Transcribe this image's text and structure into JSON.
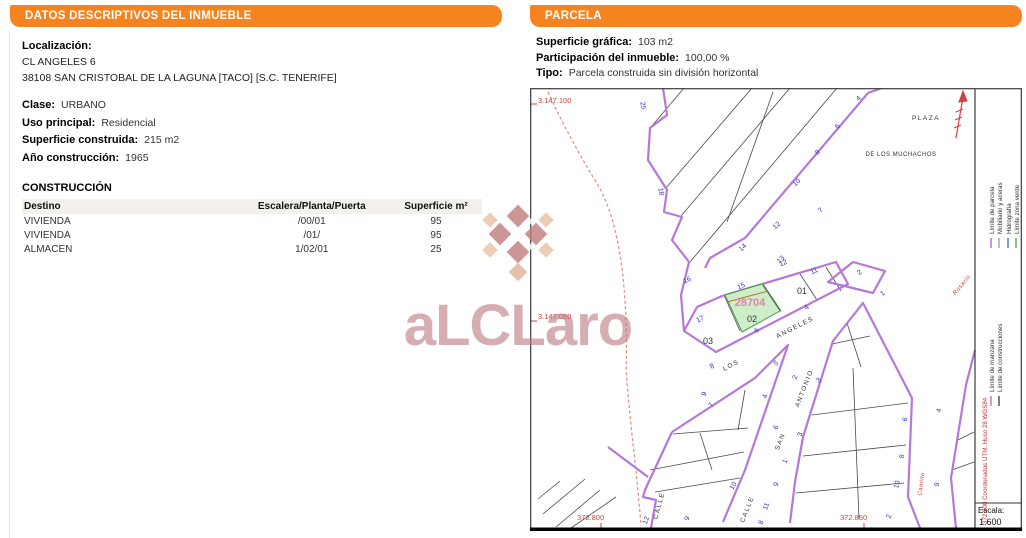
{
  "colors": {
    "accent_orange": "#F5831F",
    "parcel_line_purple": "#b678d8",
    "highlight_green_fill": "#cdeec8",
    "ref_pink": "#e37fb1",
    "coord_red": "#cf4436",
    "house_number_blue": "#2a35c0"
  },
  "left_panel": {
    "header": "DATOS DESCRIPTIVOS DEL INMUEBLE",
    "localizacion_label": "Localización:",
    "address_line1": "CL ANGELES 6",
    "address_line2": "38108 SAN CRISTOBAL DE LA LAGUNA [TACO] [S.C. TENERIFE]",
    "fields": [
      {
        "label": "Clase:",
        "value": "URBANO"
      },
      {
        "label": "Uso principal:",
        "value": "Residencial"
      },
      {
        "label": "Superficie construida:",
        "value": "215 m2"
      },
      {
        "label": "Año construcción:",
        "value": "1965"
      }
    ],
    "construccion": {
      "title": "CONSTRUCCIÓN",
      "columns": [
        "Destino",
        "Escalera/Planta/Puerta",
        "Superficie m²"
      ],
      "rows": [
        [
          "VIVIENDA",
          "/00/01",
          "95"
        ],
        [
          "VIVIENDA",
          "/01/",
          "95"
        ],
        [
          "ALMACEN",
          "1/02/01",
          "25"
        ]
      ]
    }
  },
  "right_panel": {
    "header": "PARCELA",
    "fields": [
      {
        "label": "Superficie gráfica:",
        "value": "103 m2"
      },
      {
        "label": "Participación del inmueble:",
        "value": "100,00 %"
      },
      {
        "label": "Tipo:",
        "value": "Parcela construida sin división horizontal"
      }
    ]
  },
  "map": {
    "coord_labels": {
      "top_left": "3.147.100",
      "mid_left": "3.147.050",
      "bottom_left": "372.800",
      "bottom_right": "372.850"
    },
    "plaza": {
      "line1": "PLAZA",
      "line2": "DE LOS MUCHACHOS"
    },
    "parcel_ref": "28704",
    "parcel_numbers": {
      "p01": "01",
      "p02": "02",
      "p03": "03"
    },
    "street_labels": {
      "angeles": "ANGELES",
      "los": "LOS",
      "calle_sa": "CALLE",
      "san": "SAN",
      "antonio": "ANTONIO",
      "calle_bl": "CALLE",
      "camino": "Camino",
      "rosario": "Rosario"
    },
    "house_numbers": [
      {
        "t": "25",
        "x": 641,
        "y": 106,
        "r": 78
      },
      {
        "t": "18",
        "x": 659,
        "y": 192,
        "r": 78
      },
      {
        "t": "14",
        "x": 744,
        "y": 249,
        "r": -42
      },
      {
        "t": "12",
        "x": 778,
        "y": 227,
        "r": -42
      },
      {
        "t": "10",
        "x": 798,
        "y": 184,
        "r": -42
      },
      {
        "t": "8",
        "x": 819,
        "y": 154,
        "r": -42
      },
      {
        "t": "6",
        "x": 839,
        "y": 128,
        "r": -42
      },
      {
        "t": "4",
        "x": 860,
        "y": 100,
        "r": -42
      },
      {
        "t": "13",
        "x": 782,
        "y": 261,
        "r": -42
      },
      {
        "t": "7",
        "x": 822,
        "y": 212,
        "r": -42
      },
      {
        "t": "16",
        "x": 688,
        "y": 282,
        "r": -25
      },
      {
        "t": "17",
        "x": 701,
        "y": 321,
        "r": -25
      },
      {
        "t": "15",
        "x": 742,
        "y": 288,
        "r": -25
      },
      {
        "t": "12",
        "x": 784,
        "y": 265,
        "r": -25
      },
      {
        "t": "11",
        "x": 815,
        "y": 273,
        "r": -25
      },
      {
        "t": "4",
        "x": 808,
        "y": 309,
        "r": -40
      },
      {
        "t": "6",
        "x": 758,
        "y": 332,
        "r": -40
      },
      {
        "t": "8",
        "x": 713,
        "y": 368,
        "r": -30
      },
      {
        "t": "2",
        "x": 861,
        "y": 274,
        "r": -40
      },
      {
        "t": "5",
        "x": 777,
        "y": 365,
        "r": -30
      },
      {
        "t": "9",
        "x": 706,
        "y": 395,
        "r": -60
      },
      {
        "t": "7",
        "x": 713,
        "y": 406,
        "r": -60
      },
      {
        "t": "4",
        "x": 767,
        "y": 397,
        "r": -70
      },
      {
        "t": "6",
        "x": 778,
        "y": 428,
        "r": -70
      },
      {
        "t": "1",
        "x": 787,
        "y": 462,
        "r": -70
      },
      {
        "t": "9",
        "x": 778,
        "y": 485,
        "r": -70
      },
      {
        "t": "11",
        "x": 768,
        "y": 507,
        "r": -70
      },
      {
        "t": "8",
        "x": 763,
        "y": 523,
        "r": -70
      },
      {
        "t": "2",
        "x": 797,
        "y": 378,
        "r": -70
      },
      {
        "t": "3",
        "x": 820,
        "y": 382,
        "r": -40
      },
      {
        "t": "3",
        "x": 802,
        "y": 435,
        "r": -70
      },
      {
        "t": "1",
        "x": 884,
        "y": 295,
        "r": -40
      },
      {
        "t": "12",
        "x": 648,
        "y": 521,
        "r": -70
      },
      {
        "t": "9",
        "x": 689,
        "y": 519,
        "r": -70
      },
      {
        "t": "10",
        "x": 735,
        "y": 487,
        "r": -60
      },
      {
        "t": "6",
        "x": 907,
        "y": 420,
        "r": -75
      },
      {
        "t": "8",
        "x": 904,
        "y": 457,
        "r": -75
      },
      {
        "t": "10",
        "x": 899,
        "y": 485,
        "r": -75
      },
      {
        "t": "2",
        "x": 891,
        "y": 517,
        "r": -75
      },
      {
        "t": "9",
        "x": 939,
        "y": 485,
        "r": -75
      },
      {
        "t": "4",
        "x": 941,
        "y": 411,
        "r": -75
      }
    ],
    "legend": {
      "entries": [
        {
          "label": "Límite de parcela",
          "color": "#b678d8"
        },
        {
          "label": "Mobiliario y aceras",
          "color": "#a8a8a8"
        },
        {
          "label": "Hidrografía",
          "color": "#5577cc"
        },
        {
          "label": "Límite zona verde",
          "color": "#66aa55"
        },
        {
          "label": "Límite de manzana",
          "color": "#d873b8"
        },
        {
          "label": "Límite de construcciones",
          "color": "#555555"
        }
      ],
      "utm_note": "372.900 Coordenadas UTM. Huso 28 WGS84"
    },
    "scale": {
      "label": "Escala:",
      "value": "1.600"
    }
  },
  "watermark": {
    "text": "aLCLaro"
  }
}
